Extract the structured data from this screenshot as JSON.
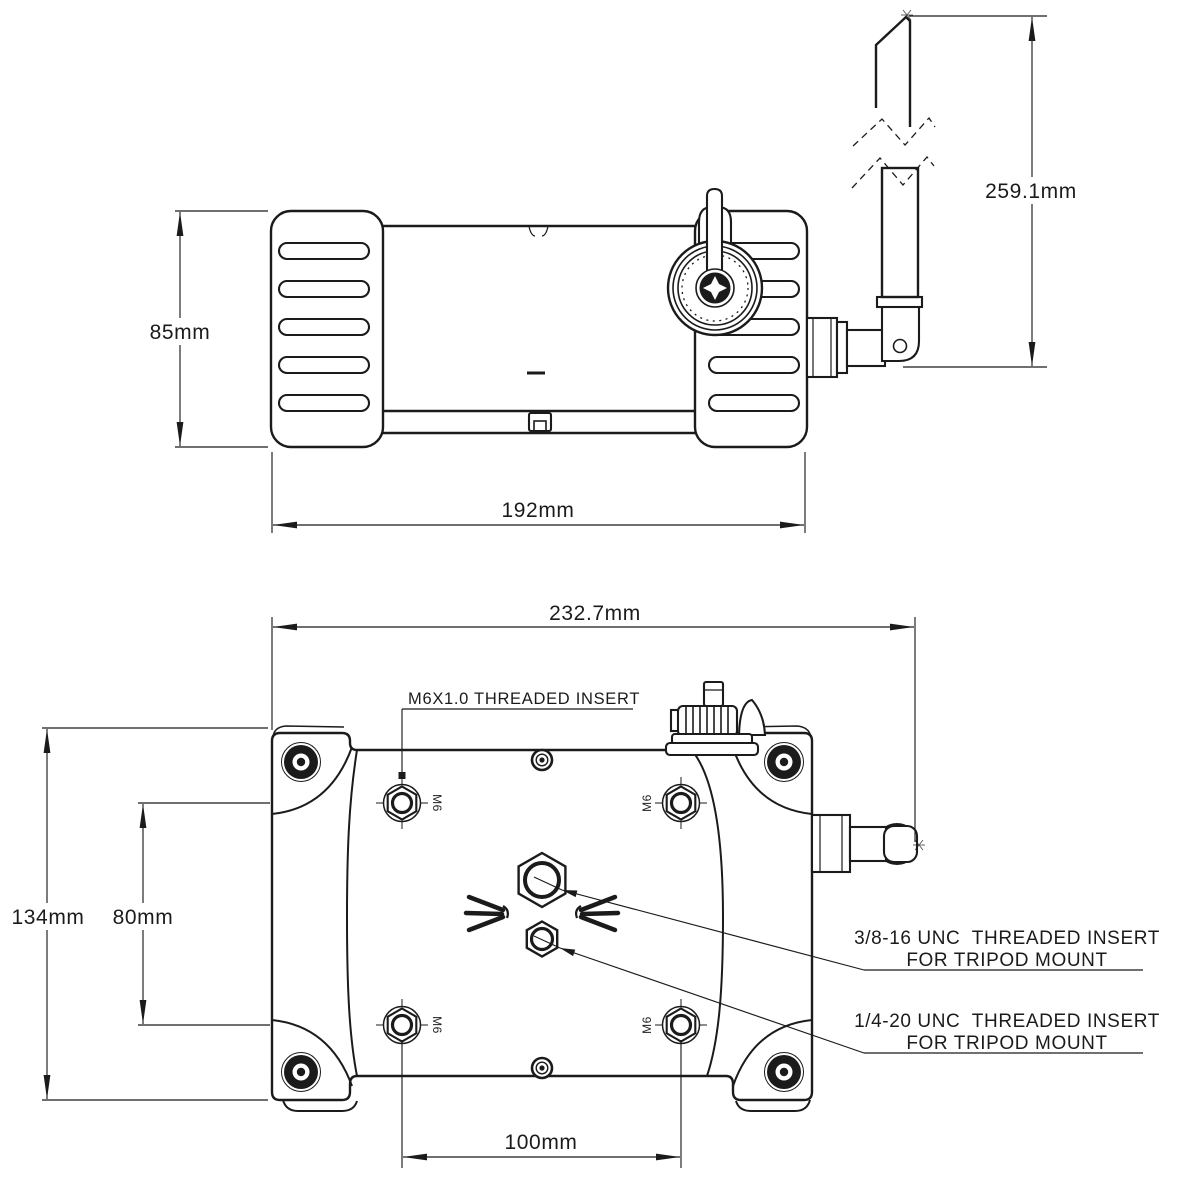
{
  "title": "device-dimension-drawing",
  "colors": {
    "ink": "#1b1b1b",
    "background": "#ffffff"
  },
  "side_view": {
    "dim_height": "85mm",
    "dim_width": "192mm",
    "dim_antenna_height": "259.1mm"
  },
  "bottom_view": {
    "dim_width": "232.7mm",
    "dim_height": "134mm",
    "dim_insert_spacing_vertical": "80mm",
    "dim_insert_spacing_horizontal": "100mm",
    "insert_marking": "M6",
    "callout_m6": "M6X1.0 THREADED INSERT",
    "callout_tripod38_line1": "3/8-16 UNC  THREADED INSERT",
    "callout_tripod38_line2": "FOR TRIPOD MOUNT",
    "callout_tripod14_line1": "1/4-20 UNC  THREADED INSERT",
    "callout_tripod14_line2": "FOR TRIPOD MOUNT"
  }
}
